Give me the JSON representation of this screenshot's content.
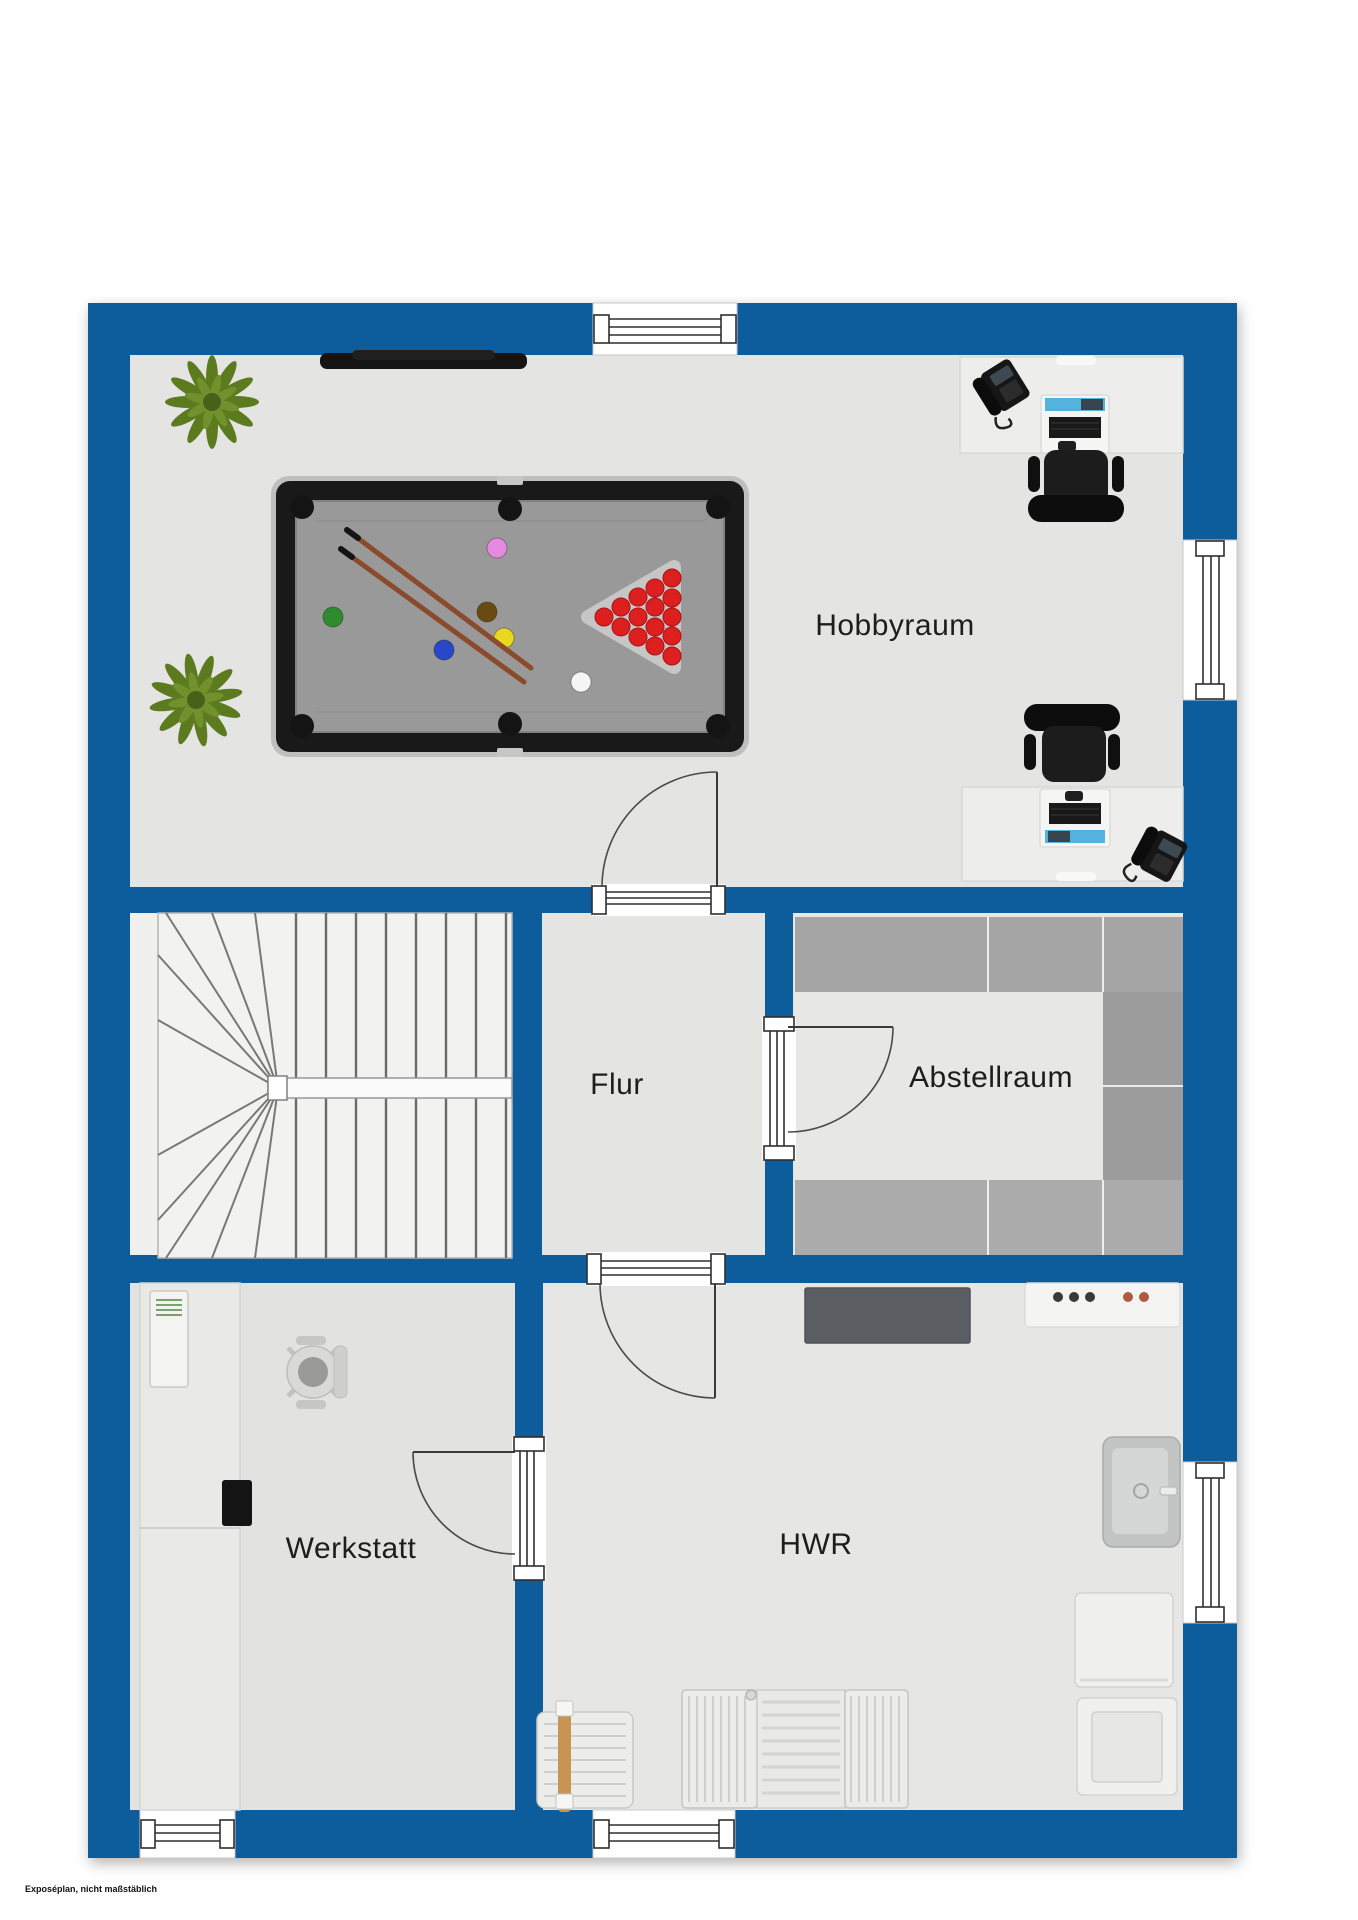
{
  "rooms": {
    "hobbyraum": {
      "label": "Hobbyraum"
    },
    "flur": {
      "label": "Flur"
    },
    "abstellraum": {
      "label": "Abstellraum"
    },
    "werkstatt": {
      "label": "Werkstatt"
    },
    "hwr": {
      "label": "HWR"
    }
  },
  "footer": {
    "note": "Exposéplan, nicht maßstäblich"
  },
  "colors": {
    "wall": "#0e5c9c",
    "floor": "#e4e4e3",
    "floor_light": "#f0f0ef",
    "shelf": "#a5a5a5",
    "screen": "#53b3dd",
    "ball_red": "#dd1f1f",
    "plant": "#5c7a1e",
    "cue": "#8a4b2c",
    "text": "#1d1d1d"
  },
  "furniture_icons": [
    "pool-table-icon",
    "plant-icon",
    "wall-tv-icon",
    "desk-icon",
    "desk-phone-icon",
    "computer-icon",
    "office-chair-icon",
    "winder-stairs-icon",
    "shelving-icon",
    "workbench-icon",
    "heater-cabinet-icon",
    "storage-box-icon",
    "sideboard-icon",
    "cooktop-counter-icon",
    "sink-icon",
    "washing-machine-icon",
    "dryer-icon",
    "drying-rack-icon",
    "radiator-icon",
    "doormat-icon",
    "door-swing-icon",
    "window-icon"
  ]
}
